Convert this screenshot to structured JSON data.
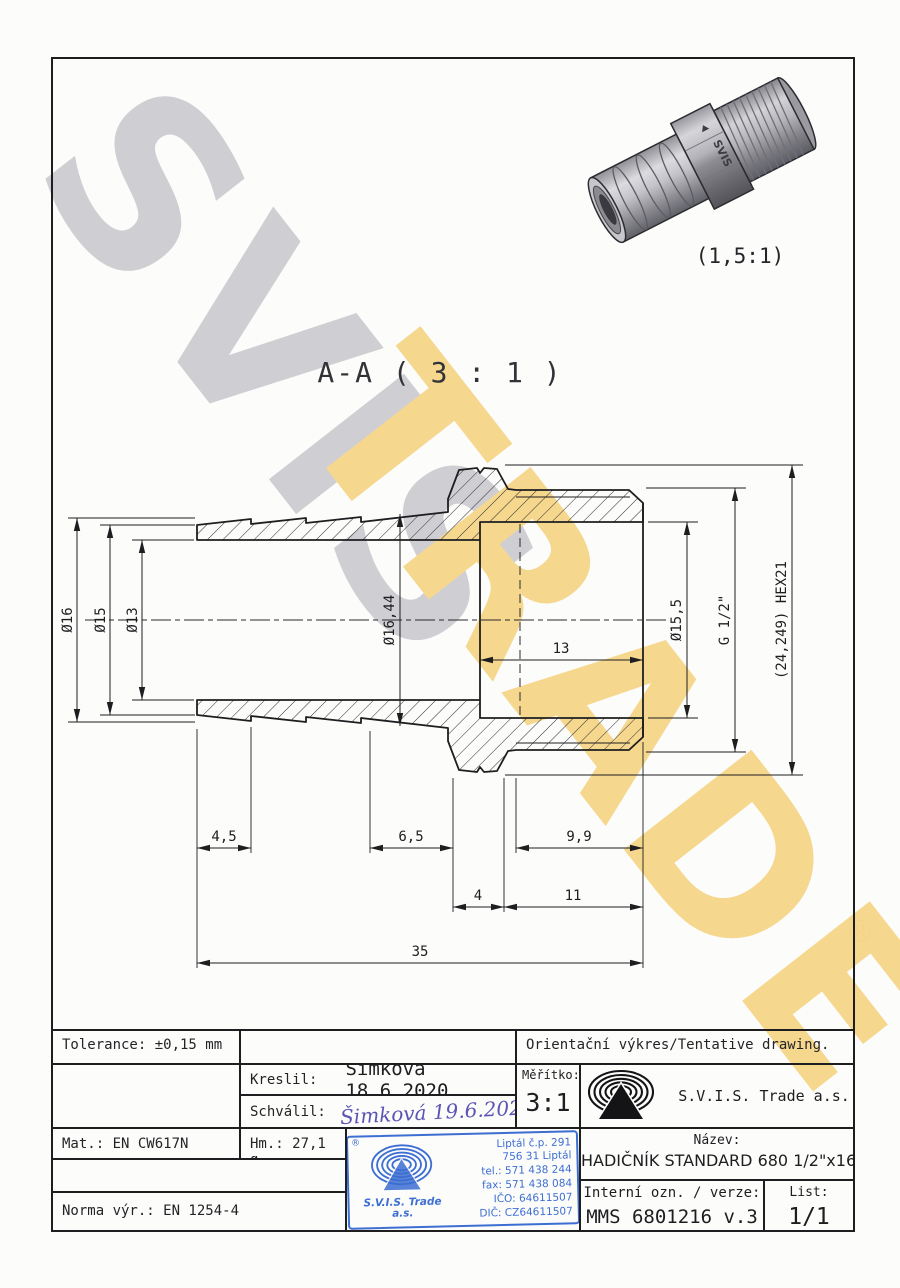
{
  "page": {
    "watermark_primary": "SVIS",
    "watermark_secondary": "TRADE",
    "registered_mark": "®",
    "section_label": "A-A ( 3 : 1 )",
    "render_scale": "(1,5:1)",
    "render_marking": "SVIS"
  },
  "dimensions": {
    "dia16": "Ø16",
    "dia15": "Ø15",
    "dia13": "Ø13",
    "dia16_44": "Ø16,44",
    "dia15_5": "Ø15,5",
    "thread": "G 1/2\"",
    "hex": "(24,249) HEX21",
    "len4_5": "4,5",
    "len6_5": "6,5",
    "len9_9": "9,9",
    "len4": "4",
    "len11": "11",
    "len13": "13",
    "len35": "35"
  },
  "title_block": {
    "tolerance": "Tolerance: ±0,15 mm",
    "orientacni": "Orientační výkres/Tentative drawing.",
    "kreslil_label": "Kreslil:",
    "kreslil_value": "Šimková 18.6.2020",
    "schvalil_label": "Schválil:",
    "schvalil_value": "Šimková 19.6.2020",
    "meritko_label": "Měřítko:",
    "meritko_value": "3:1",
    "company": "S.V.I.S. Trade a.s.",
    "mat": "Mat.: EN CW617N",
    "hm": "Hm.: 27,1 g",
    "norma": "Norma výr.: EN 1254-4",
    "nazev_label": "Název:",
    "nazev_value": "HADIČNÍK STANDARD 680 1/2\"x16",
    "interni_label": "Interní ozn. / verze:",
    "interni_value": "MMS 6801216 v.3",
    "list_label": "List:",
    "list_value": "1/1"
  },
  "stamp": {
    "registered": "®",
    "company": "S.V.I.S. Trade",
    "company_suffix": "a.s.",
    "lines": [
      "Liptál č.p. 291",
      "756 31 Liptál",
      "tel.: 571 438 244",
      "fax: 571 438 084",
      "IČO: 64611507",
      "DIČ: CZ64611507"
    ],
    "color": "#3d6ed2"
  }
}
